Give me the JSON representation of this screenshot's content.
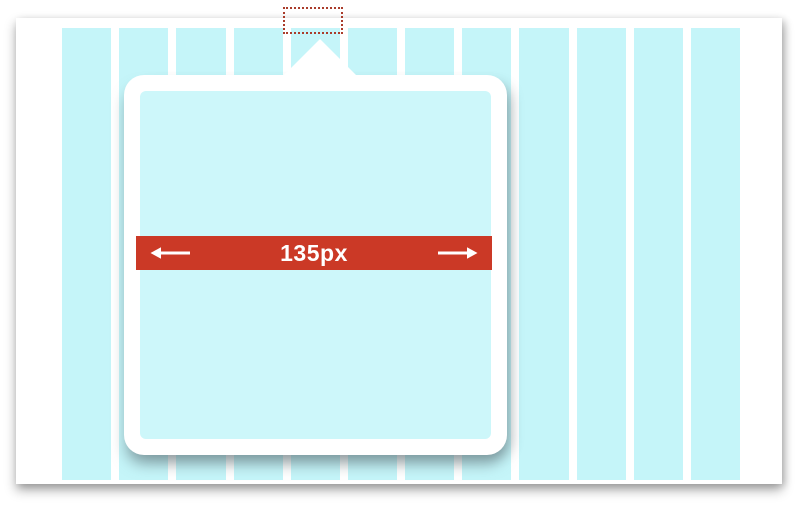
{
  "illustration": {
    "measurement_band": {
      "label": "135px",
      "arrow_left_icon": "←",
      "arrow_right_icon": "→"
    },
    "grid": {
      "column_count": 12
    },
    "colors": {
      "column_cyan": "#c5f5f9",
      "popover_fill_cyan": "#cdf7fa",
      "measurement_red": "#cb3926",
      "anchor_outline_red": "#aa3c2b",
      "surface_white": "#ffffff"
    }
  }
}
